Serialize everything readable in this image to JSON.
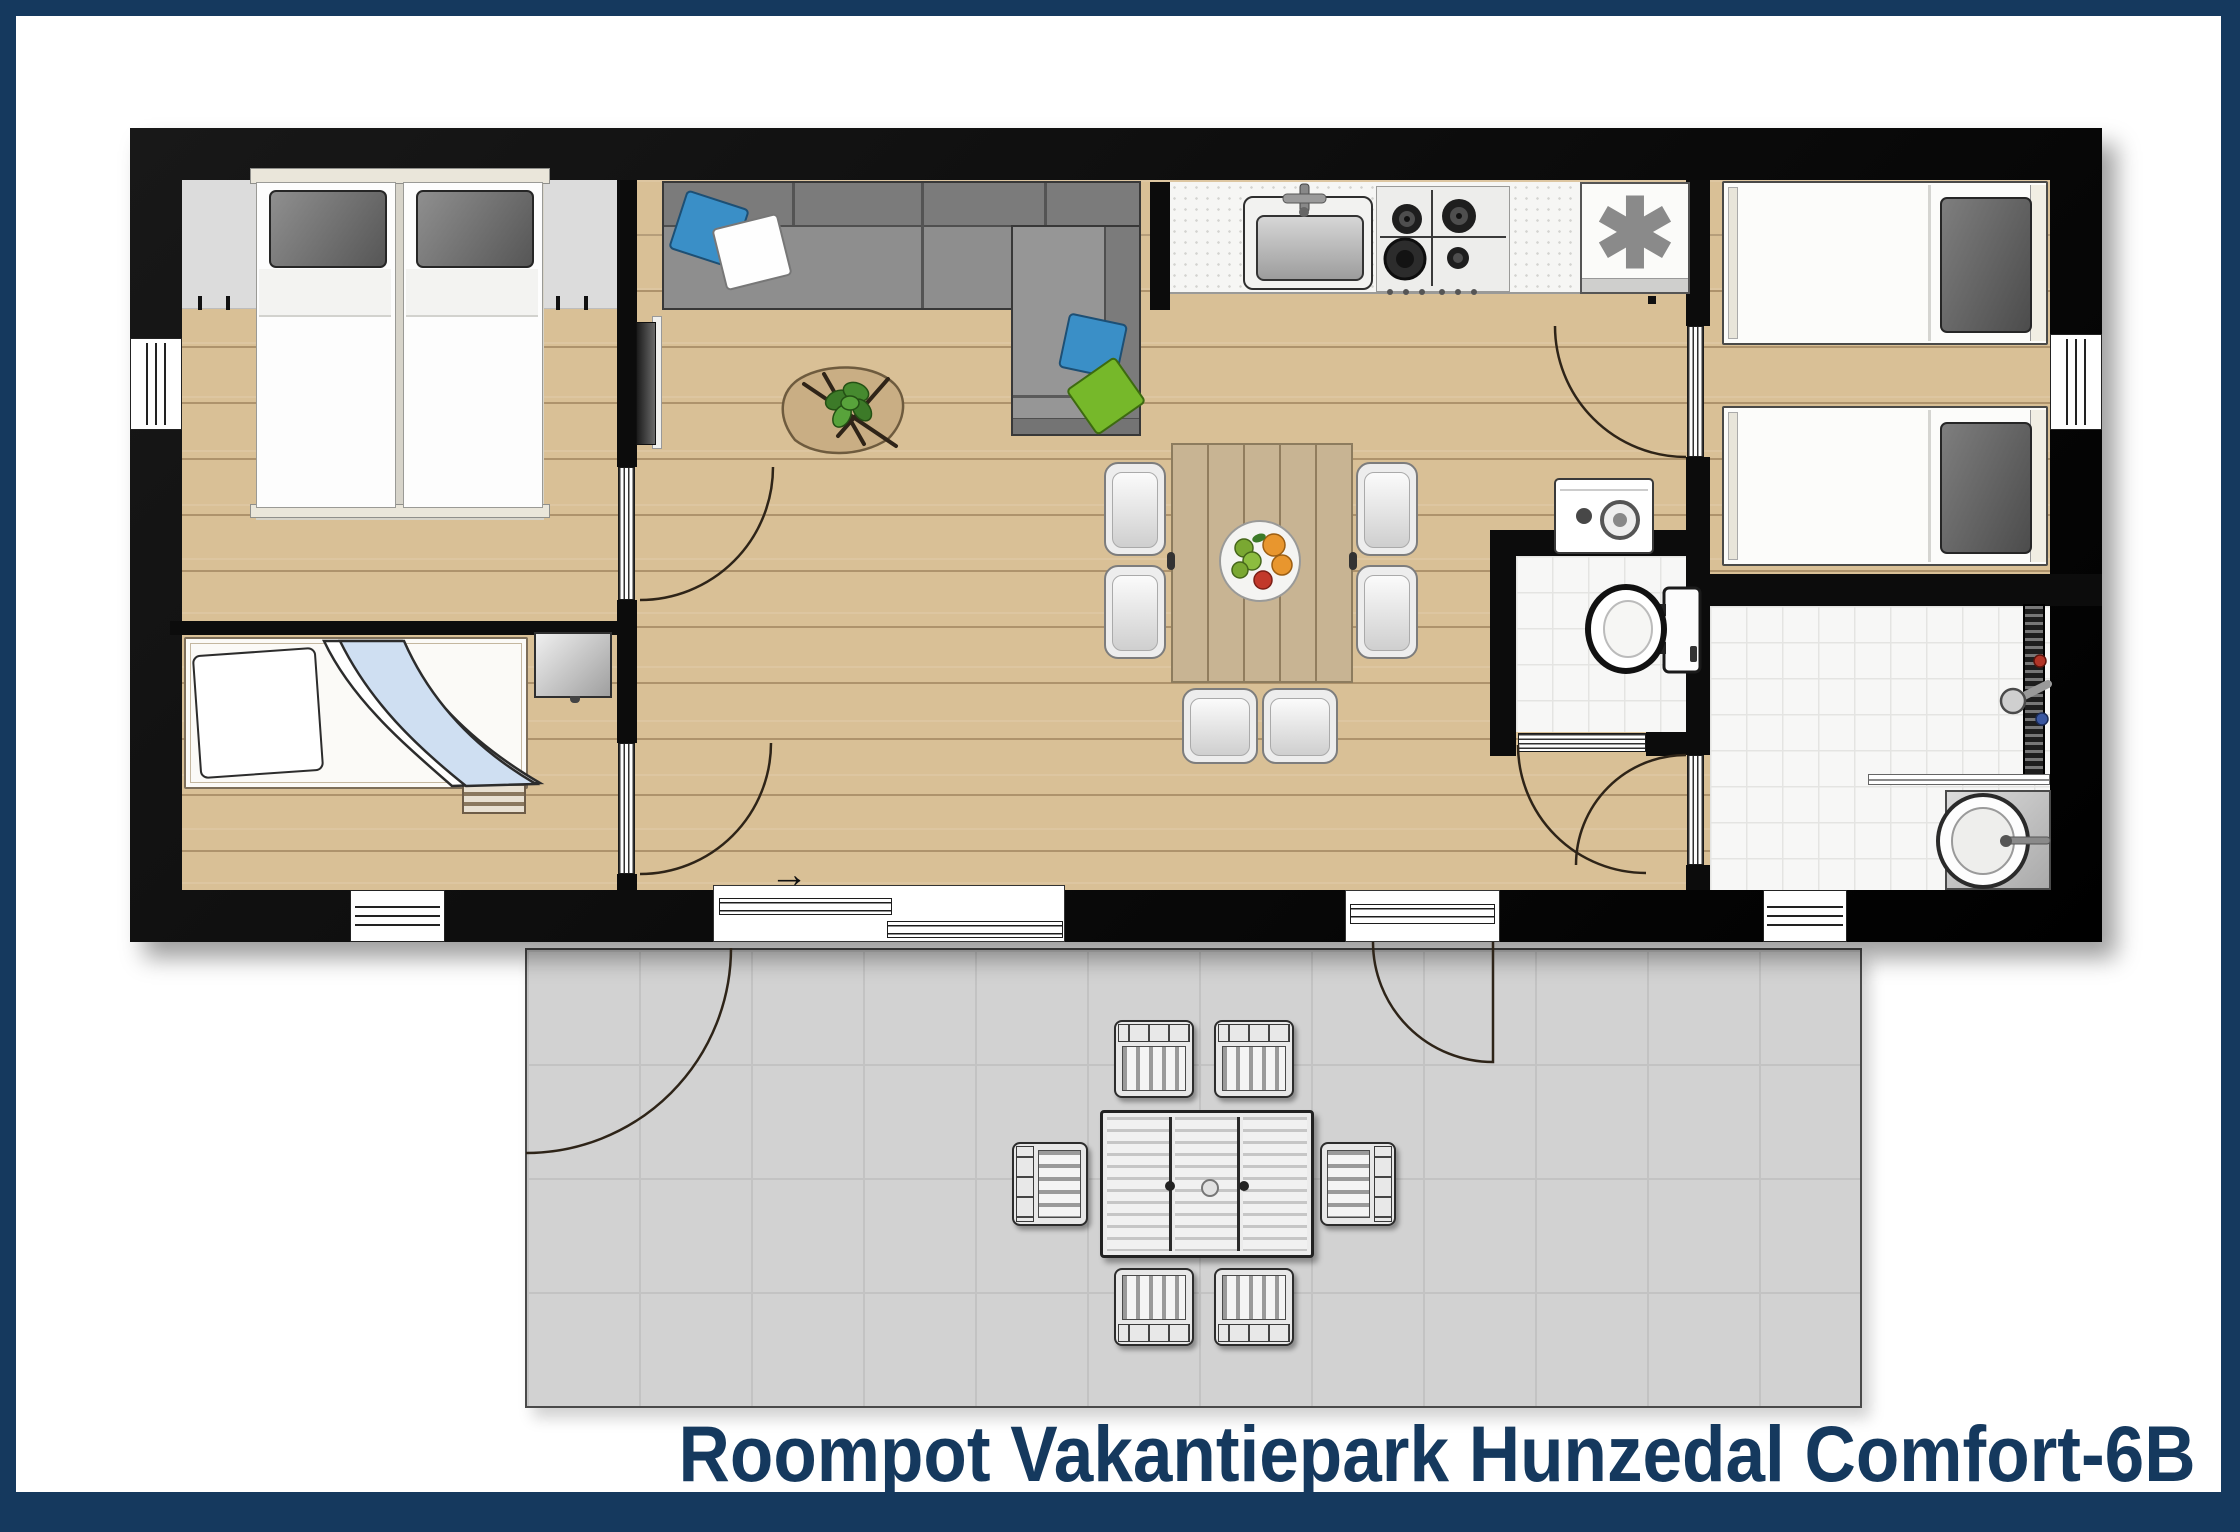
{
  "title": {
    "text": "Roompot Vakantiepark Hunzedal Comfort-6B",
    "color": "#15395e"
  },
  "symbols": {
    "freezer_asterisk": "✱",
    "entrance_arrow": "→"
  },
  "palette": {
    "border_navy": "#15395e",
    "wall_black": "#0c0c0c",
    "wood_floor": "#d9c096",
    "tile_white": "#f7f7f6",
    "terrace_gray": "#d2d2d2",
    "headboard_gray": "#dcdcdc",
    "sofa_gray": "#8e8e8e",
    "pillow_blue": "#3a8fc7",
    "pillow_green": "#76b82a",
    "blanket_blue": "#cfdff2"
  }
}
